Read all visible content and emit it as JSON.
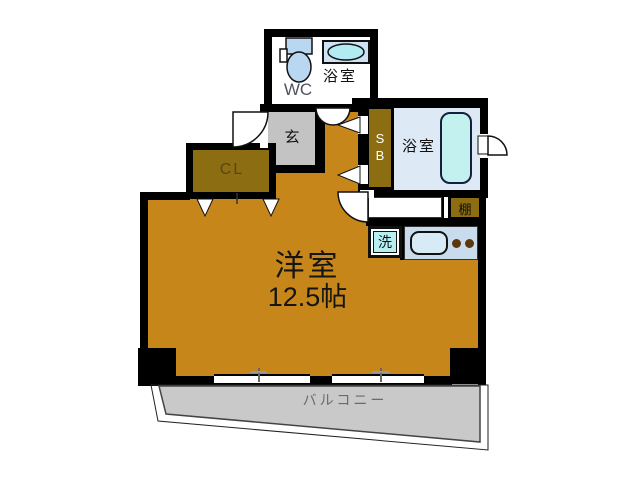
{
  "title": "apartment-floorplan",
  "rooms": {
    "main": {
      "name": "洋室",
      "size": "12.5帖"
    },
    "wc": "WC",
    "bath_top": "浴室",
    "bath_right": "浴室",
    "entrance": "玄",
    "closet": "CL",
    "shoe_box": "SB",
    "shelf": "棚",
    "laundry": "洗",
    "balcony": "バルコニー"
  },
  "colors": {
    "wall": "#000000",
    "main_room": "#c7861a",
    "storage": "#8c6d12",
    "entrance_floor": "#c3c3c3",
    "balcony_floor": "#c9c9c9",
    "bath_floor": "#dde9f4",
    "bathtub": "#c3f1f0",
    "fixture_blue": "#bad7f2",
    "kitchen_counter": "#c9dcee",
    "laundry_fill": "#b7eef0"
  }
}
